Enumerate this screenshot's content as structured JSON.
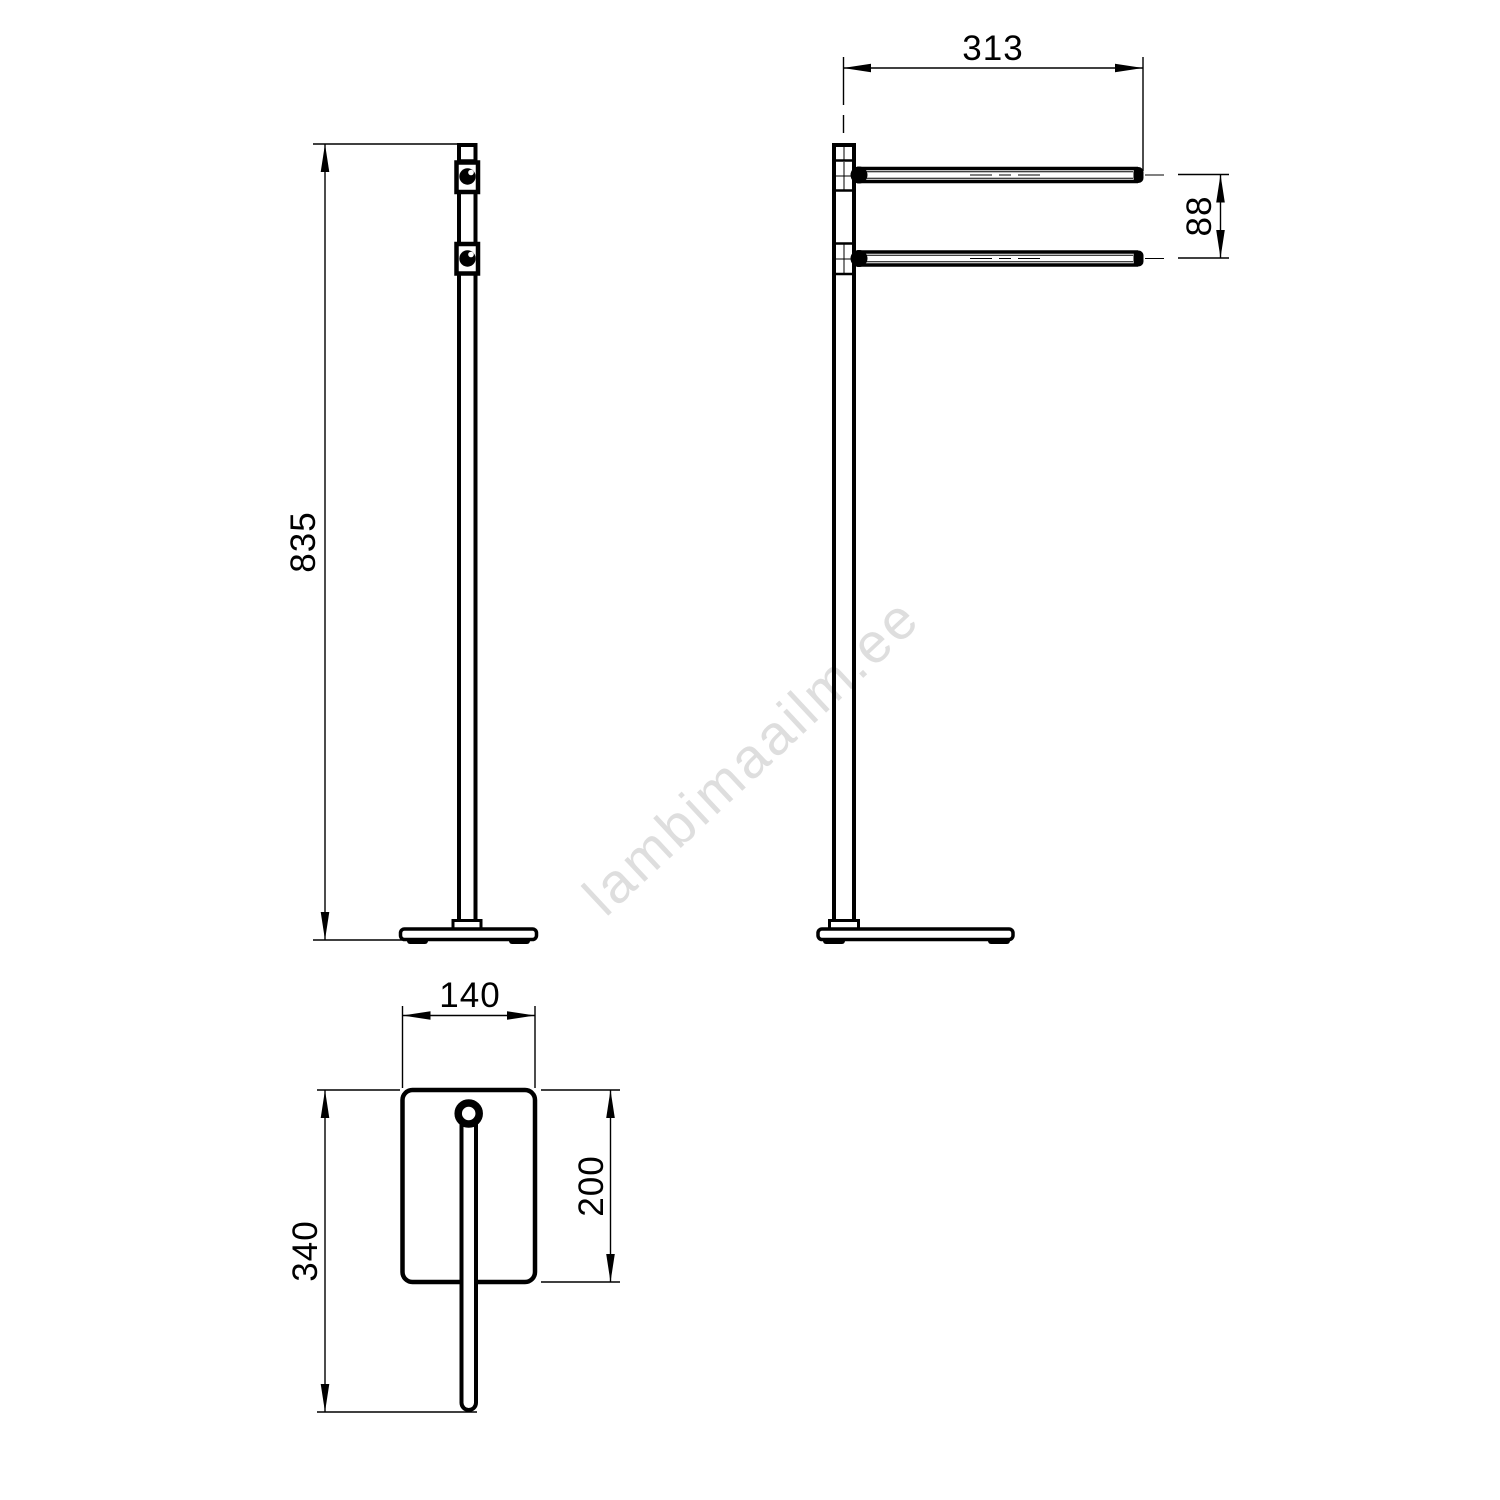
{
  "drawing": {
    "watermark": "lambimaailm.ee",
    "dimensions": {
      "height": "835",
      "bar_length": "313",
      "bar_spacing": "88",
      "base_width": "140",
      "base_depth": "200",
      "overall_depth": "340"
    },
    "colors": {
      "line": "#000000",
      "background": "#ffffff",
      "watermark": "#dedede"
    }
  }
}
